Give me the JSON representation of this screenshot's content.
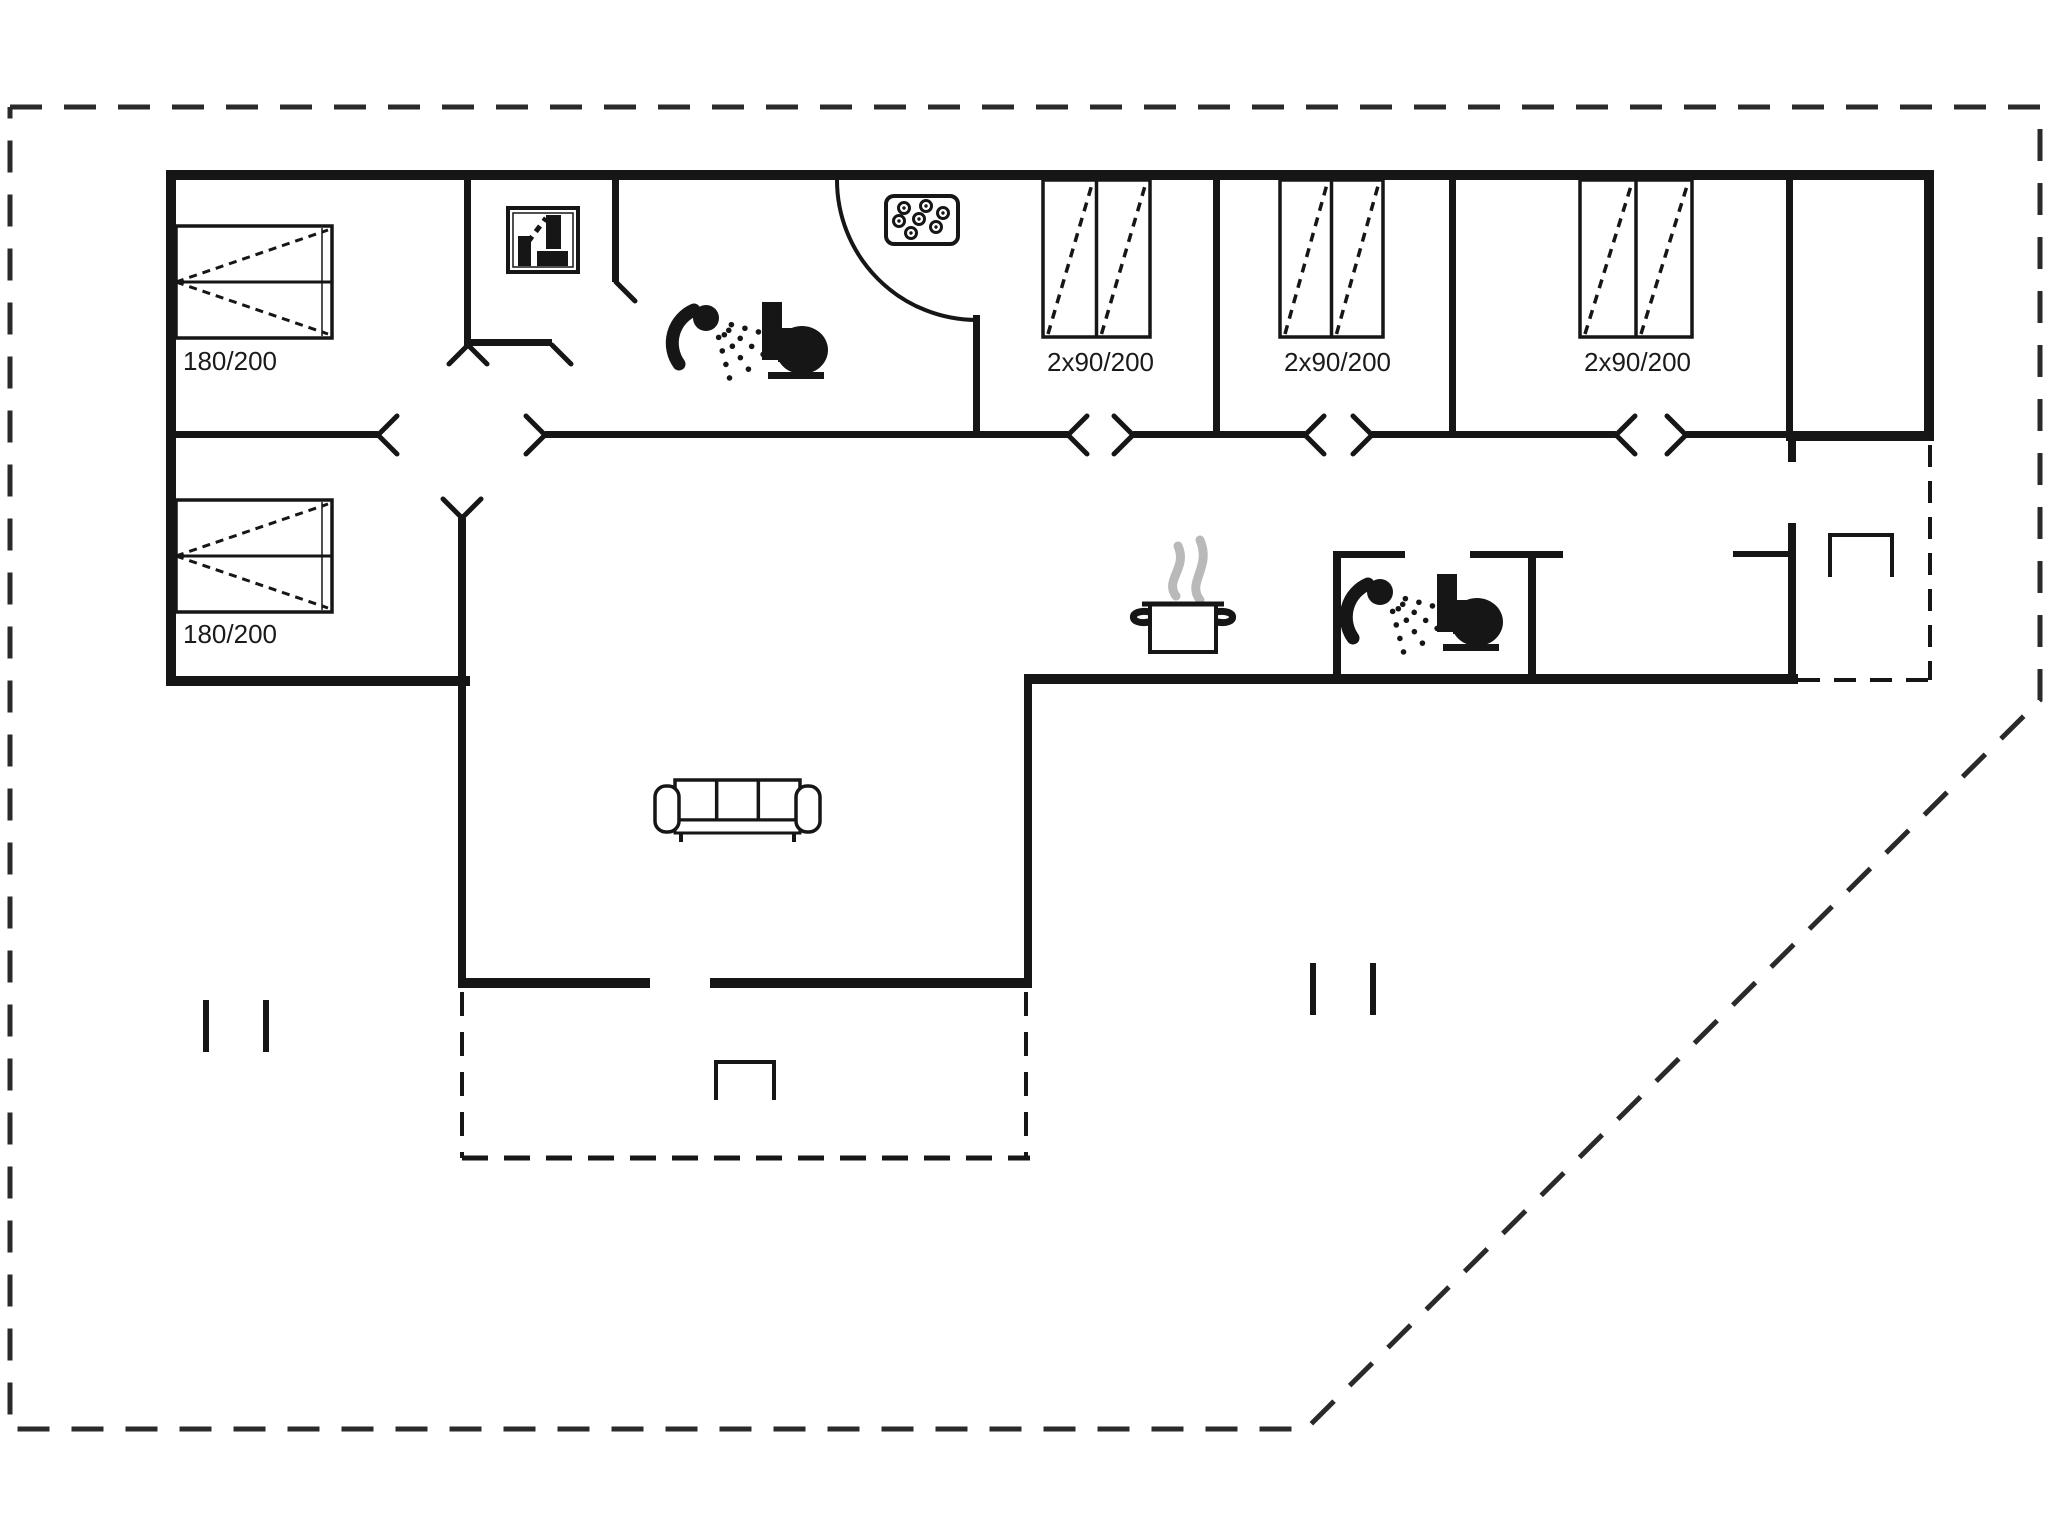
{
  "canvas": {
    "w": 2048,
    "h": 1536,
    "bg": "#ffffff"
  },
  "palette": {
    "ink": "#161616",
    "boundary": "#2a2a2a",
    "steam": "#b9b9b9"
  },
  "boundary": {
    "points": [
      [
        10,
        107
      ],
      [
        2040,
        107
      ],
      [
        2040,
        700
      ],
      [
        1306,
        1429
      ],
      [
        10,
        1429
      ],
      [
        10,
        107
      ]
    ],
    "dash": "32 22",
    "width": 5
  },
  "walls": [
    {
      "x": 166,
      "y": 170,
      "w": 1768,
      "h": 10
    },
    {
      "x": 166,
      "y": 170,
      "w": 10,
      "h": 516
    },
    {
      "x": 1924,
      "y": 170,
      "w": 10,
      "h": 271
    },
    {
      "x": 166,
      "y": 676,
      "w": 304,
      "h": 10
    },
    {
      "x": 458,
      "y": 518,
      "w": 8,
      "h": 470
    },
    {
      "x": 458,
      "y": 978,
      "w": 192,
      "h": 10
    },
    {
      "x": 710,
      "y": 978,
      "w": 322,
      "h": 10
    },
    {
      "x": 1024,
      "y": 683,
      "w": 8,
      "h": 305
    },
    {
      "x": 1024,
      "y": 674,
      "w": 774,
      "h": 10
    },
    {
      "x": 1786,
      "y": 431,
      "w": 148,
      "h": 10
    },
    {
      "x": 1788,
      "y": 441,
      "w": 8,
      "h": 21
    },
    {
      "x": 1788,
      "y": 523,
      "w": 8,
      "h": 161
    },
    {
      "x": 1733,
      "y": 551,
      "w": 57,
      "h": 6
    },
    {
      "x": 464,
      "y": 180,
      "w": 7,
      "h": 165
    },
    {
      "x": 612,
      "y": 180,
      "w": 7,
      "h": 102
    },
    {
      "x": 973,
      "y": 315,
      "w": 7,
      "h": 123
    },
    {
      "x": 1213,
      "y": 180,
      "w": 7,
      "h": 258
    },
    {
      "x": 1449,
      "y": 180,
      "w": 7,
      "h": 258
    },
    {
      "x": 1786,
      "y": 180,
      "w": 7,
      "h": 258
    },
    {
      "x": 464,
      "y": 339,
      "w": 88,
      "h": 7
    },
    {
      "x": 166,
      "y": 431,
      "w": 212,
      "h": 7
    },
    {
      "x": 545,
      "y": 431,
      "w": 523,
      "h": 7
    },
    {
      "x": 1133,
      "y": 431,
      "w": 172,
      "h": 7
    },
    {
      "x": 1372,
      "y": 431,
      "w": 244,
      "h": 7
    },
    {
      "x": 1686,
      "y": 431,
      "w": 104,
      "h": 7
    },
    {
      "x": 1333,
      "y": 552,
      "w": 8,
      "h": 132
    },
    {
      "x": 1333,
      "y": 551,
      "w": 72,
      "h": 7
    },
    {
      "x": 1470,
      "y": 551,
      "w": 93,
      "h": 7
    },
    {
      "x": 1528,
      "y": 552,
      "w": 8,
      "h": 132
    }
  ],
  "dashed_edges": [
    {
      "x1": 1930,
      "y1": 445,
      "x2": 1930,
      "y2": 680,
      "dash": "22 14",
      "w": 4
    },
    {
      "x1": 1798,
      "y1": 680,
      "x2": 1934,
      "y2": 680,
      "dash": "22 14",
      "w": 4
    },
    {
      "x1": 462,
      "y1": 992,
      "x2": 462,
      "y2": 1158,
      "dash": "24 16",
      "w": 4
    },
    {
      "x1": 462,
      "y1": 1158,
      "x2": 1030,
      "y2": 1158,
      "dash": "26 16",
      "w": 5
    },
    {
      "x1": 1026,
      "y1": 992,
      "x2": 1026,
      "y2": 1158,
      "dash": "24 16",
      "w": 4
    }
  ],
  "door_arc": {
    "d": "M 837 180 A 140 140 0 0 0 977 320",
    "width": 4
  },
  "door_ticks": [
    {
      "x": 378,
      "y": 435,
      "dir": "ne"
    },
    {
      "x": 378,
      "y": 435,
      "dir": "se"
    },
    {
      "x": 545,
      "y": 435,
      "dir": "nw"
    },
    {
      "x": 545,
      "y": 435,
      "dir": "sw"
    },
    {
      "x": 1068,
      "y": 435,
      "dir": "ne"
    },
    {
      "x": 1068,
      "y": 435,
      "dir": "se"
    },
    {
      "x": 1133,
      "y": 435,
      "dir": "nw"
    },
    {
      "x": 1133,
      "y": 435,
      "dir": "sw"
    },
    {
      "x": 1305,
      "y": 435,
      "dir": "ne"
    },
    {
      "x": 1305,
      "y": 435,
      "dir": "se"
    },
    {
      "x": 1372,
      "y": 435,
      "dir": "nw"
    },
    {
      "x": 1372,
      "y": 435,
      "dir": "sw"
    },
    {
      "x": 1616,
      "y": 435,
      "dir": "ne"
    },
    {
      "x": 1616,
      "y": 435,
      "dir": "se"
    },
    {
      "x": 1686,
      "y": 435,
      "dir": "nw"
    },
    {
      "x": 1686,
      "y": 435,
      "dir": "sw"
    },
    {
      "x": 468,
      "y": 345,
      "dir": "se"
    },
    {
      "x": 468,
      "y": 345,
      "dir": "sw"
    },
    {
      "x": 552,
      "y": 345,
      "dir": "se"
    },
    {
      "x": 616,
      "y": 282,
      "dir": "se"
    },
    {
      "x": 462,
      "y": 518,
      "dir": "ne"
    },
    {
      "x": 462,
      "y": 518,
      "dir": "nw"
    }
  ],
  "beds": [
    {
      "x": 176,
      "y": 226,
      "w": 156,
      "h": 112,
      "label": "180/200",
      "lx": 183,
      "ly": 370
    },
    {
      "x": 176,
      "y": 500,
      "w": 156,
      "h": 112,
      "label": "180/200",
      "lx": 183,
      "ly": 643
    }
  ],
  "wardrobes": [
    {
      "x": 1043,
      "y": 180,
      "w": 107,
      "h": 157,
      "label": "2x90/200",
      "lx": 1047,
      "ly": 371
    },
    {
      "x": 1280,
      "y": 180,
      "w": 103,
      "h": 157,
      "label": "2x90/200",
      "lx": 1284,
      "ly": 371
    },
    {
      "x": 1580,
      "y": 180,
      "w": 112,
      "h": 157,
      "label": "2x90/200",
      "lx": 1584,
      "ly": 371
    }
  ],
  "fixtures": {
    "washer": {
      "name": "washing-machine-icon",
      "x": 508,
      "y": 208,
      "w": 70,
      "h": 64
    },
    "whirlpool": {
      "name": "whirlpool-icon",
      "x": 886,
      "y": 196,
      "w": 72,
      "h": 48,
      "bubbles": [
        [
          18,
          12
        ],
        [
          40,
          10
        ],
        [
          57,
          17
        ],
        [
          13,
          25
        ],
        [
          33,
          23
        ],
        [
          50,
          31
        ],
        [
          25,
          37
        ]
      ]
    },
    "showers": [
      {
        "name": "shower-icon",
        "x": 706,
        "y": 318
      },
      {
        "name": "shower-icon",
        "x": 1380,
        "y": 592
      }
    ],
    "toilets": [
      {
        "name": "toilet-icon",
        "x": 762,
        "y": 302
      },
      {
        "name": "toilet-icon",
        "x": 1437,
        "y": 574
      }
    ],
    "pot": {
      "name": "cooking-pot-icon",
      "x": 1128,
      "y": 538
    },
    "sofa": {
      "name": "sofa-icon",
      "x": 655,
      "y": 780,
      "w": 165,
      "h": 62
    },
    "steps": [
      {
        "name": "step-symbol",
        "x": 716,
        "y": 1062,
        "w": 58,
        "h": 38
      },
      {
        "name": "step-symbol",
        "x": 1830,
        "y": 535,
        "w": 62,
        "h": 42
      }
    ],
    "tick_pairs": [
      {
        "name": "boundary-tick-marks",
        "x1": 206,
        "x2": 266,
        "y1": 1000,
        "y2": 1052
      },
      {
        "name": "boundary-tick-marks",
        "x1": 1313,
        "x2": 1373,
        "y1": 963,
        "y2": 1015
      }
    ]
  }
}
